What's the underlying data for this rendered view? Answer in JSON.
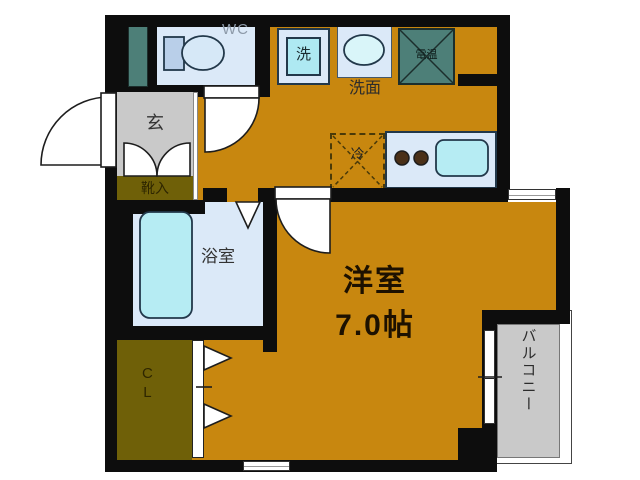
{
  "floorplan": {
    "rooms": {
      "wc": {
        "label": "WC"
      },
      "washing_machine": {
        "label": "洗"
      },
      "washstand": {
        "label": "洗面"
      },
      "water_heater": {
        "label": "電温"
      },
      "entrance": {
        "label": "玄"
      },
      "shoe_storage": {
        "label": "靴入"
      },
      "bathroom": {
        "label": "浴室"
      },
      "refrigerator": {
        "label": "冷"
      },
      "closet": {
        "label_vertical": "C\nL"
      },
      "main_room": {
        "label": "洋室",
        "size": "7.0帖"
      },
      "balcony": {
        "label": "バルコニー"
      }
    },
    "colors": {
      "floor_orange": "#c8870f",
      "closet_olive": "#6f6008",
      "utility_teal": "#4d7f78",
      "room_lightblue": "#dbe9f8",
      "fixture_cyan": "#b6ecf3",
      "hall_gray": "#c9c9c9",
      "wall_black": "#0d0d0d"
    }
  }
}
